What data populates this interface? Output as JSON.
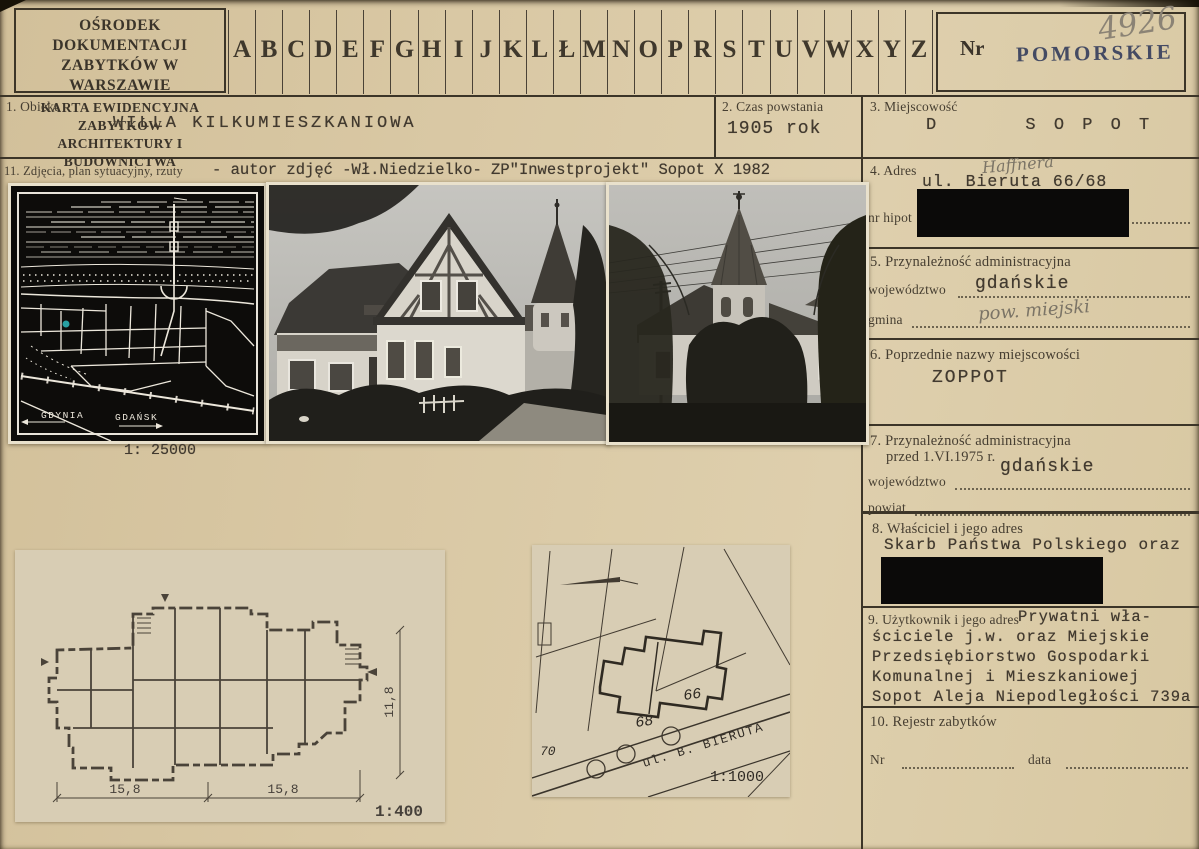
{
  "header": {
    "org_line1": "OŚRODEK DOKUMENTACJI",
    "org_line2": "ZABYTKÓW W WARSZAWIE",
    "card_line1": "KARTA EWIDENCYJNA ZABYTKÓW",
    "card_line2": "ARCHITEKTURY I BUDOWNICTWA",
    "alphabet": [
      "A",
      "B",
      "C",
      "D",
      "E",
      "F",
      "G",
      "H",
      "I",
      "J",
      "K",
      "L",
      "Ł",
      "M",
      "N",
      "O",
      "P",
      "R",
      "S",
      "T",
      "U",
      "V",
      "W",
      "X",
      "Y",
      "Z"
    ],
    "nr_label": "Nr",
    "region_stamp": "POMORSKIE",
    "card_number": "4926"
  },
  "fields": {
    "f1": {
      "label": "1. Obiekt",
      "value": "WILLA KILKUMIESZKANIOWA"
    },
    "f2": {
      "label": "2. Czas powstania",
      "value": "1905 rok"
    },
    "f3": {
      "label": "3. Miejscowość",
      "value": "D      S O P O T"
    },
    "f11": {
      "label": "11. Zdjęcia, plan sytuacyjny, rzuty",
      "value": "- autor zdjęć -Wł.Niedzielko- ZP\"Inwestprojekt\" Sopot X 1982"
    },
    "f4": {
      "label": "4. Adres",
      "handwritten": "Haffnera",
      "value": "ul. Bieruta 66/68",
      "sub_label": "nr hipot"
    },
    "f5": {
      "label": "5. Przynależność administracyjna",
      "woj_label": "województwo",
      "woj_value": "gdańskie",
      "gmina_label": "gmina",
      "gmina_hand": "pow. miejski"
    },
    "f6": {
      "label": "6. Poprzednie nazwy miejscowości",
      "value": "ZOPPOT"
    },
    "f7": {
      "label_line1": "7. Przynależność administracyjna",
      "label_line2": "przed 1.VI.1975 r.",
      "woj_label": "województwo",
      "woj_value": "gdańskie",
      "powiat_label": "powiat"
    },
    "f8": {
      "label": "8. Właściciel i jego adres",
      "value": "Skarb Państwa Polskiego oraz"
    },
    "f9": {
      "label": "9. Użytkownik i jego adres",
      "first_line": "Prywatni wła-",
      "lines": [
        "ściciele j.w. oraz Miejskie",
        "Przedsiębiorstwo Gospodarki",
        "Komunalnej i Mieszkaniowej",
        "Sopot Aleja Niepodległości 739a"
      ]
    },
    "f10": {
      "label": "10. Rejestr zabytków",
      "nr_label": "Nr",
      "data_label": "data"
    }
  },
  "map": {
    "label_gdynia": "GDYNIA",
    "label_gdansk": "GDAŃSK",
    "scale": "1: 25000"
  },
  "floor_plan": {
    "dim_left": "15,8",
    "dim_right": "15,8",
    "dim_height": "11,8",
    "scale": "1:400"
  },
  "site_plan": {
    "n66": "66",
    "n68": "68",
    "n70": "70",
    "street": "ul. B. BIERUTA",
    "scale": "1:1000"
  },
  "colors": {
    "paper": "#d9c8a4",
    "ink": "#3c3528",
    "stamp_blue": "#38405e",
    "pencil": "#8b8375",
    "redaction": "#0b0a09",
    "map_dot_teal": "#27a0a2"
  }
}
